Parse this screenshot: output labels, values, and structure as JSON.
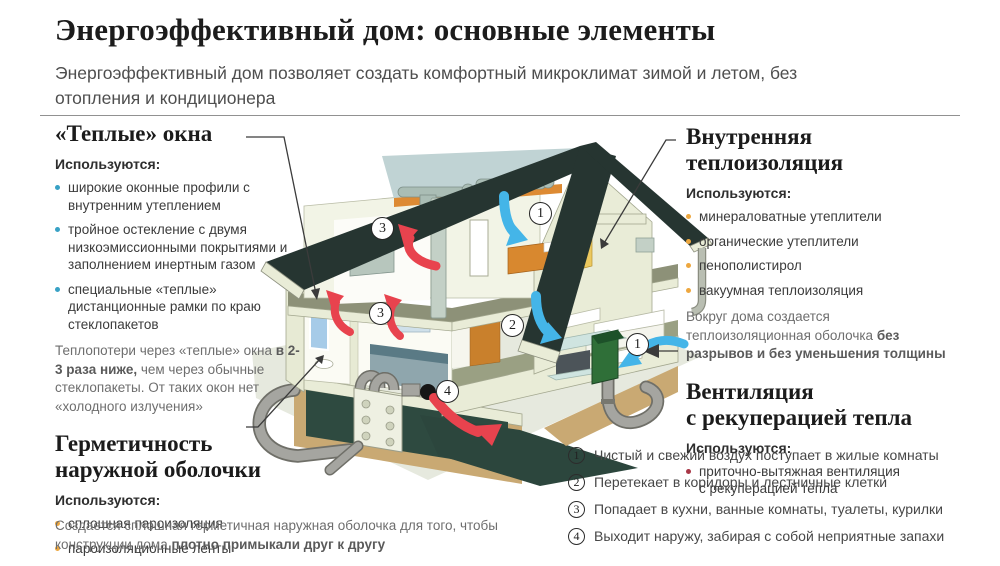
{
  "page": {
    "title": "Энергоэффективный дом: основные элементы",
    "subtitle": "Энергоэффективный дом позволяет создать комфортный микроклимат зимой и летом, без отопления и кондиционера"
  },
  "sections": {
    "warm_windows": {
      "title": "«Теплые» окна",
      "uses_label": "Используются:",
      "items": [
        "широкие оконные профили с внутренним утеплением",
        "тройное остекление с двумя низкоэмиссионными покрытиями и заполнением инертным газом",
        "специальные «теплые» дистанционные рамки по краю стеклопакетов"
      ],
      "note_pre": "Теплопотери через «теплые» окна ",
      "note_bold": "в 2-3 раза ниже,",
      "note_post": " чем через обычные стеклопакеты. От таких окон нет «холодного излучения»"
    },
    "hermetic": {
      "title_lines": [
        "Герметичность",
        "наружной оболочки"
      ],
      "uses_label": "Используются:",
      "items": [
        "сплошная пароизоляция",
        "пароизоляционные ленты"
      ],
      "note_pre": "Создается сплошная герметичная наружная оболочка для того, чтобы конструкции дома ",
      "note_bold": "плотно примыкали друг к другу"
    },
    "insulation": {
      "title_lines": [
        "Внутренняя",
        "теплоизоляция"
      ],
      "uses_label": "Используются:",
      "items": [
        "минераловатные утеплители",
        "органические утеплители",
        "пенополистирол",
        "вакуумная теплоизоляция"
      ],
      "note_pre": "Вокруг дома создается теплоизоляционная оболочка ",
      "note_bold": "без разрывов и без уменьшения толщины"
    },
    "ventilation": {
      "title_lines": [
        "Вентиляция",
        "с рекуперацией тепла"
      ],
      "uses_label": "Используются:",
      "items": [
        "приточно-вытяжная вентиляция с рекуперацией тепла"
      ]
    }
  },
  "legend": {
    "items": [
      {
        "num": "1",
        "text": "Чистый и свежий воздух поступает в жилые комнаты"
      },
      {
        "num": "2",
        "text": "Перетекает в коридоры и лестничные клетки"
      },
      {
        "num": "3",
        "text": "Попадает в кухни, ванные комнаты, туалеты, курилки"
      },
      {
        "num": "4",
        "text": "Выходит наружу, забирая с собой неприятные запахи"
      }
    ]
  },
  "markers": {
    "attic_exhaust": "3",
    "attic_supply": "1",
    "floor_exhaust": "3",
    "living_supply": "2",
    "intake": "1",
    "exhaust_out": "4"
  },
  "colors": {
    "bullet_blue": "#38a1c5",
    "bullet_orange": "#eda73f",
    "bullet_red": "#a83746",
    "arrow_red": "#e8434e",
    "arrow_blue": "#44b5e8",
    "roof_dark": "#263531",
    "wall_cream": "#e9ecd7",
    "floor_olive": "#8d9178",
    "green_unit": "#2f6f38"
  }
}
